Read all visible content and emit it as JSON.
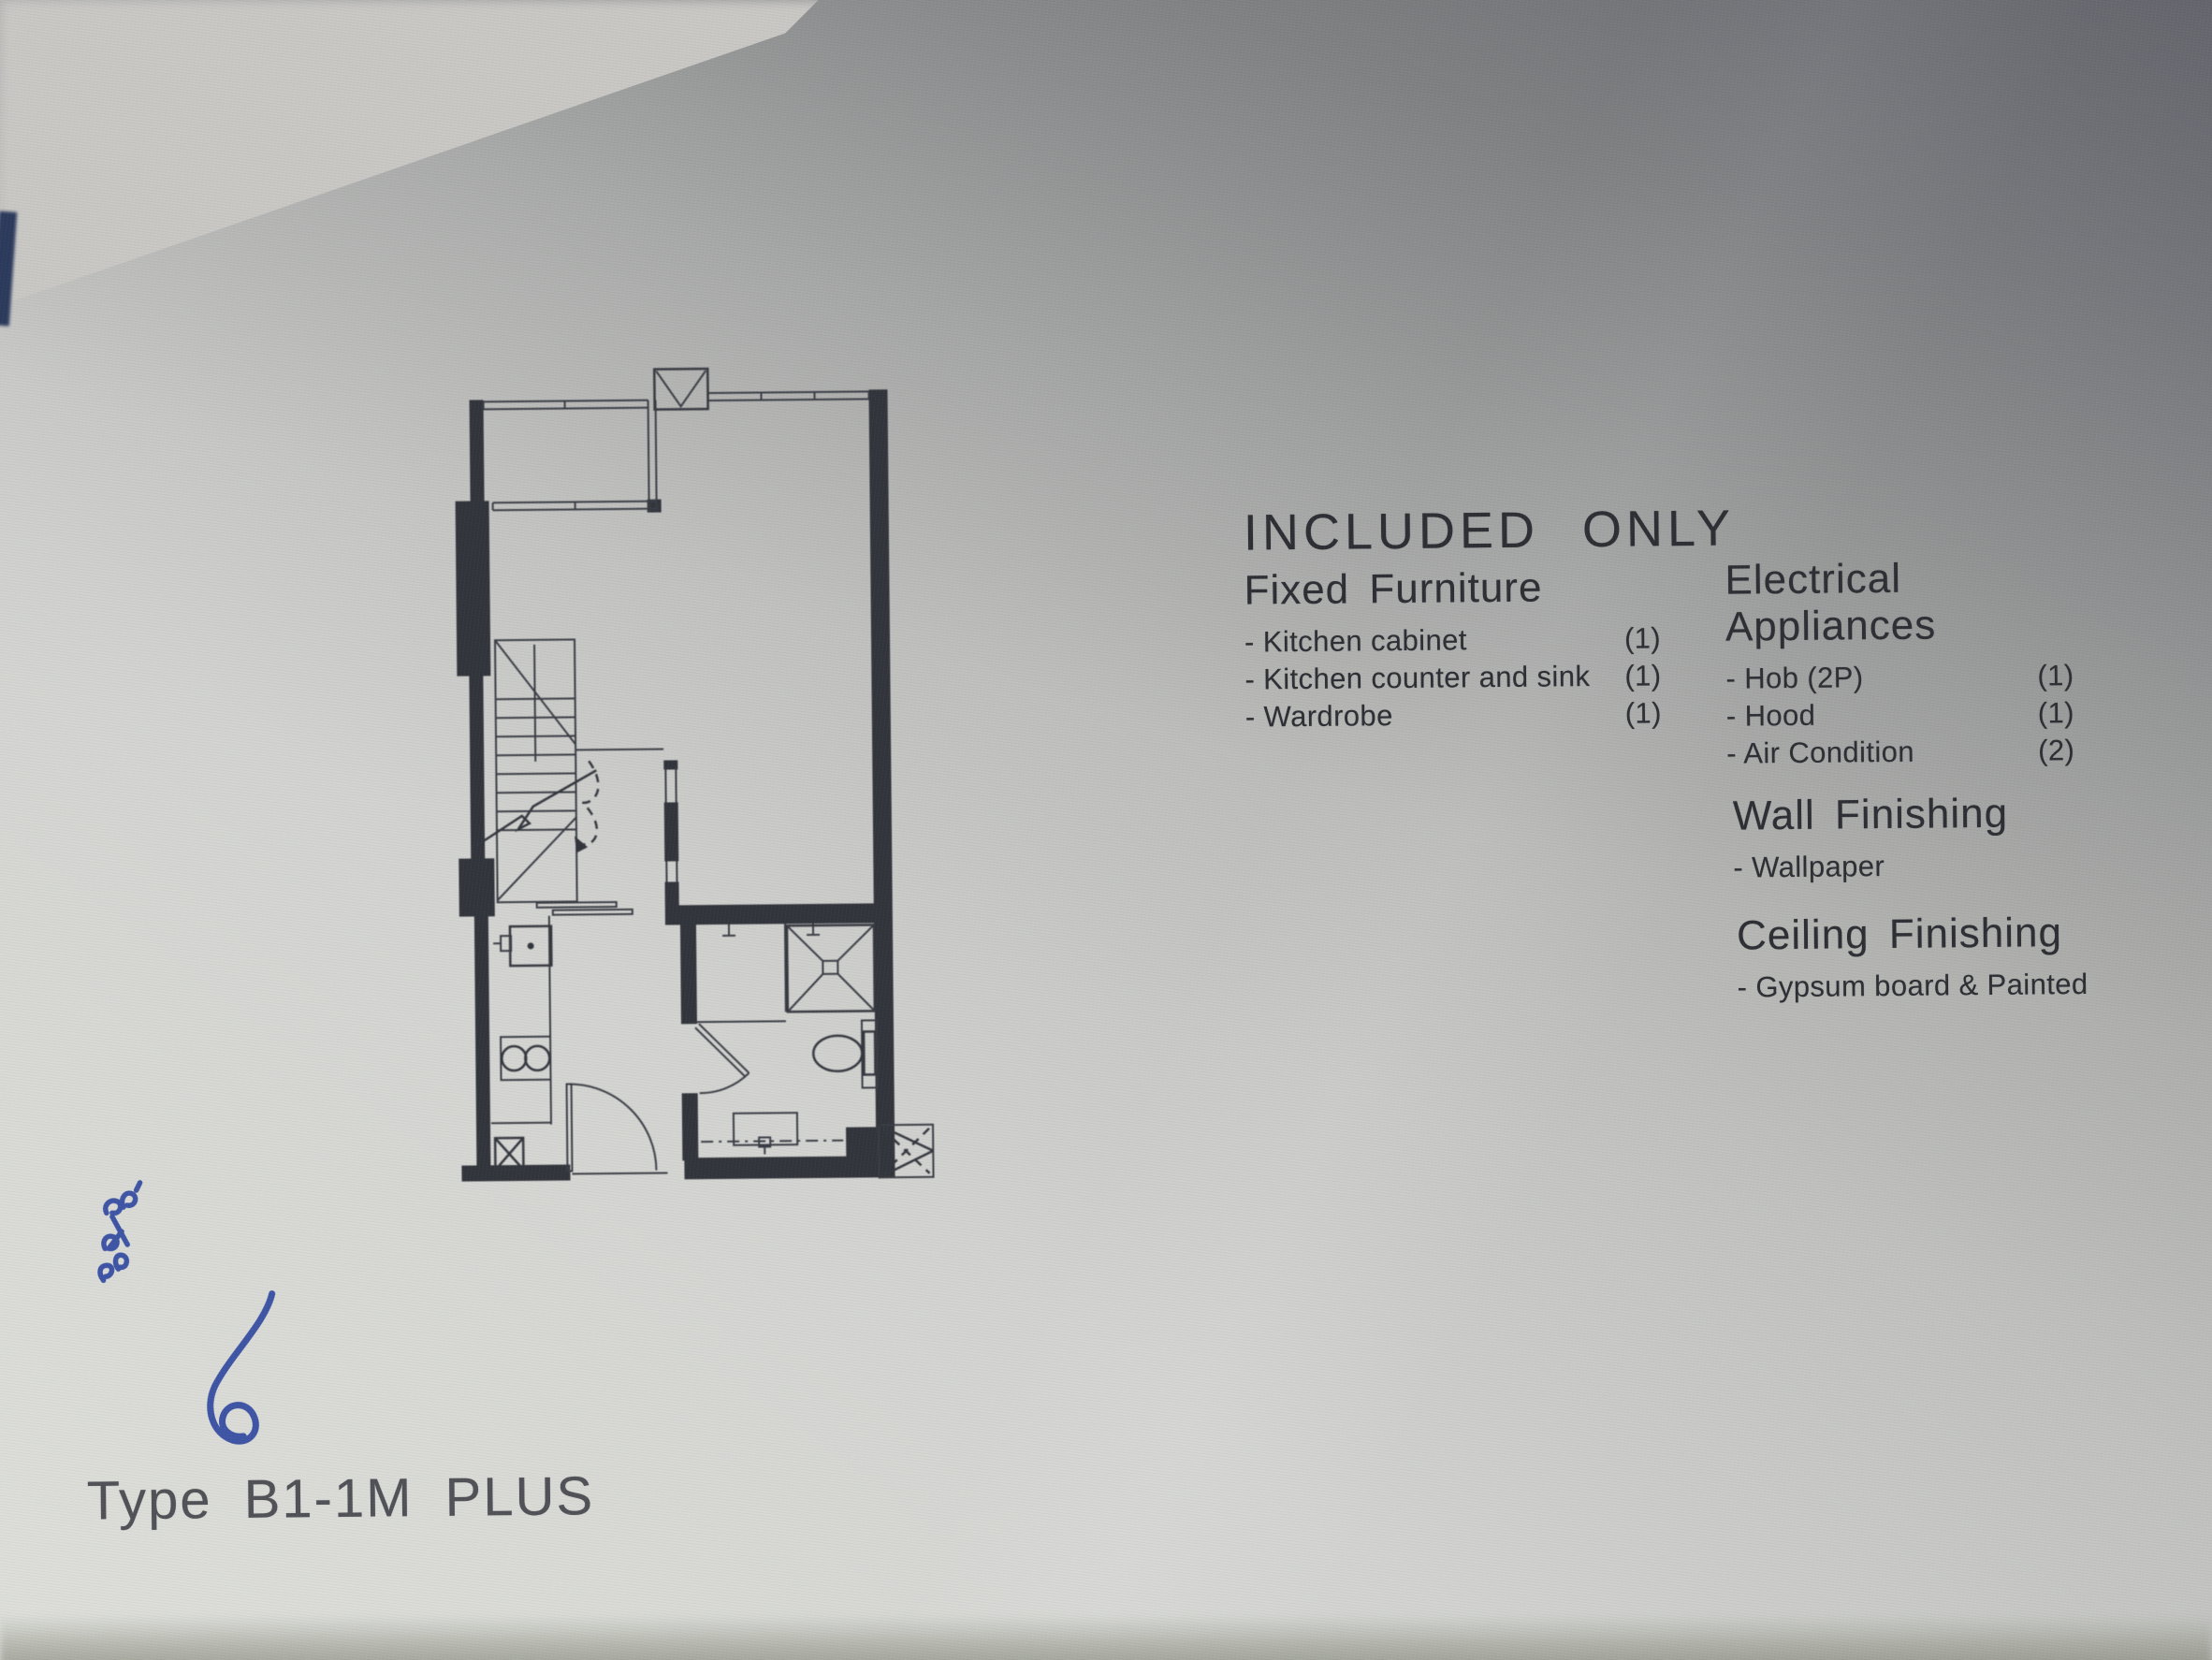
{
  "document": {
    "title": "INCLUDED ONLY",
    "type_label": "Type B1-1M PLUS",
    "fixed_furniture": {
      "heading": "Fixed Furniture",
      "items": [
        {
          "label": "- Kitchen cabinet",
          "qty": "(1)"
        },
        {
          "label": "- Kitchen counter and sink",
          "qty": "(1)"
        },
        {
          "label": "- Wardrobe",
          "qty": "(1)"
        }
      ]
    },
    "electrical_appliances": {
      "heading": "Electrical Appliances",
      "items": [
        {
          "label": "- Hob (2P)",
          "qty": "(1)"
        },
        {
          "label": "- Hood",
          "qty": "(1)"
        },
        {
          "label": "- Air Condition",
          "qty": "(2)"
        }
      ]
    },
    "wall_finishing": {
      "heading": "Wall Finishing",
      "items": [
        {
          "label": "- Wallpaper",
          "qty": ""
        }
      ]
    },
    "ceiling_finishing": {
      "heading": "Ceiling Finishing",
      "items": [
        {
          "label": "- Gypsum board & Painted",
          "qty": ""
        }
      ]
    }
  },
  "colors": {
    "ink": "#2e2f34",
    "plan_wall": "#32353c",
    "paper_light": "#dedfdb",
    "paper_shadow": "#7e7f86",
    "handwriting_blue": "#3f55a5",
    "folder_edge_navy": "#2c3a5c"
  }
}
